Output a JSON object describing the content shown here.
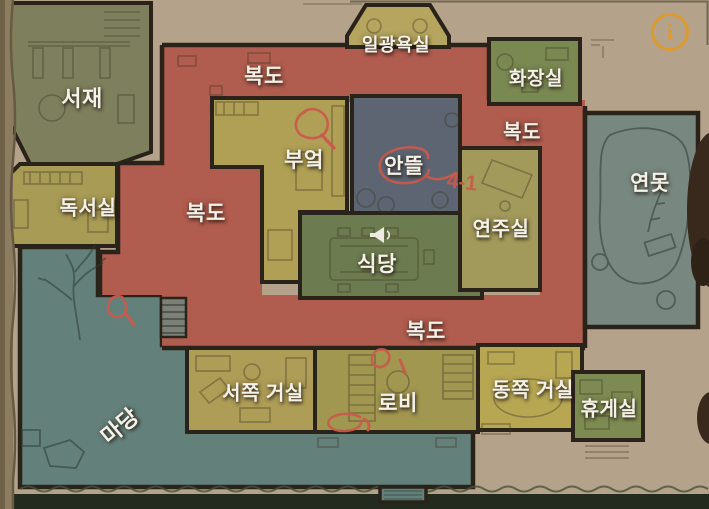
{
  "rooms": {
    "study": {
      "label": "서재"
    },
    "reading_room": {
      "label": "독서실"
    },
    "kitchen": {
      "label": "부엌"
    },
    "courtyard": {
      "label": "안뜰"
    },
    "sunroom": {
      "label": "일광욕실"
    },
    "bathroom": {
      "label": "화장실"
    },
    "music_room": {
      "label": "연주실"
    },
    "dining_room": {
      "label": "식당"
    },
    "pond": {
      "label": "연못"
    },
    "west_living_room": {
      "label": "서쪽 거실"
    },
    "lobby": {
      "label": "로비"
    },
    "east_living_room": {
      "label": "동쪽 거실"
    },
    "lounge": {
      "label": "휴게실"
    },
    "yard": {
      "label": "마당"
    }
  },
  "corridor_labels": [
    "복도",
    "복도",
    "복도",
    "복도"
  ],
  "annotations": {
    "courtyard_note": "4-1"
  },
  "info_button": {
    "glyph": "i"
  },
  "colors": {
    "background": "#b4a38a",
    "corridor": "#b05c4e",
    "courtyard": "#5c6571",
    "yard": "#64807a",
    "pond": "#788880",
    "room_yellow": "#b0a055",
    "room_green": "#6d7c50",
    "wall": "#2a231a",
    "pen_red": "#cb5a4c",
    "info_orange": "#dd9b2f",
    "label_text": "#f4f1e9"
  }
}
